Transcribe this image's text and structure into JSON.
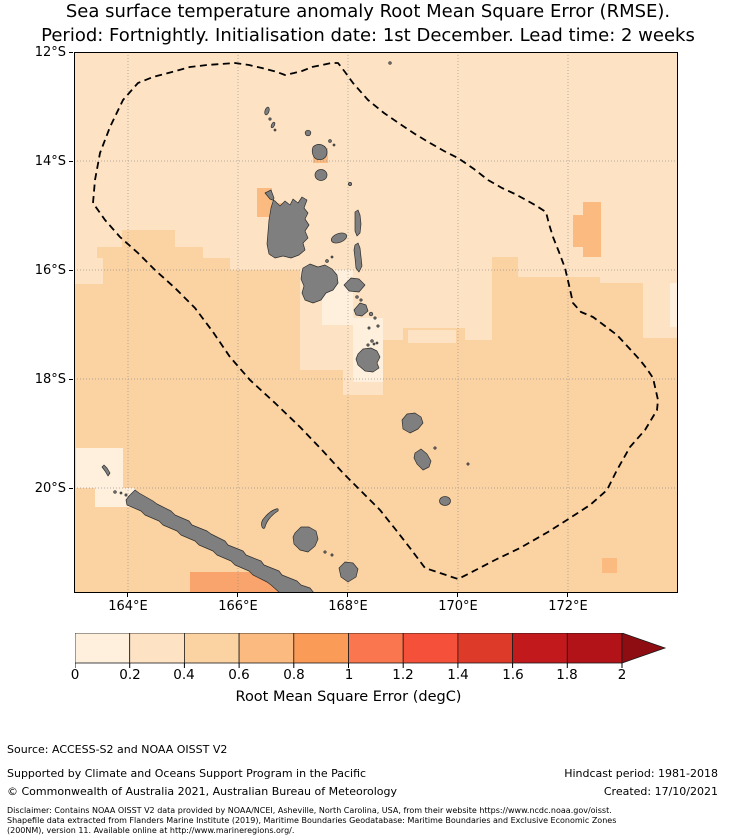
{
  "title": {
    "line1": "Sea surface temperature anomaly Root Mean Square Error (RMSE).",
    "line2": "Period: Fortnightly. Initialisation date: 1st December. Lead time: 2 weeks"
  },
  "map": {
    "lat_labels": [
      "12°S",
      "14°S",
      "16°S",
      "18°S",
      "20°S"
    ],
    "lon_labels": [
      "164°E",
      "166°E",
      "168°E",
      "170°E",
      "172°E"
    ]
  },
  "colorbar": {
    "label": "Root Mean Square Error (degC)",
    "ticks": [
      "0",
      "0.2",
      "0.4",
      "0.6",
      "0.8",
      "1",
      "1.2",
      "1.4",
      "1.6",
      "1.8",
      "2"
    ]
  },
  "footer": {
    "source": "Source: ACCESS-S2 and NOAA OISST V2",
    "supported": "Supported by Climate and Oceans Support Program in the Pacific",
    "copyright": "© Commonwealth of Australia 2021, Australian Bureau of Meteorology",
    "hindcast": "Hindcast period: 1981-2018",
    "created": "Created: 17/10/2021",
    "disclaimer_line1": "Disclaimer: Contains NOAA OISST V2 data provided by NOAA/NCEI, Asheville, North Carolina, USA, from their website https://www.ncdc.noaa.gov/oisst.",
    "disclaimer_line2": "Shapefile data extracted from Flanders Marine Institute (2019), Maritime Boundaries Geodatabase: Maritime Boundaries and Exclusive Economic Zones",
    "disclaimer_line3": "(200NM), version 11. Available online at http://www.marineregions.org/."
  },
  "colors": {
    "scale": [
      "#FEF0DC",
      "#FDE3C3",
      "#FBD2A2",
      "#FBBA80",
      "#FB9B58",
      "#F9764E",
      "#F4503A",
      "#DE3A2A",
      "#C2191D",
      "#B11318"
    ],
    "arrow": "#8E0D12",
    "patch_strong": "#F9A46C",
    "land": "#7F7F7F",
    "land_edge": "#2E2E2E",
    "grid": "#8A8A8A",
    "eez": "#000000",
    "axis": "#000000"
  },
  "chart_data": {
    "type": "heatmap",
    "title": "Sea surface temperature anomaly Root Mean Square Error (RMSE)",
    "subtitle": "Period: Fortnightly. Initialisation date: 1st December. Lead time: 2 weeks",
    "colorbar_label": "Root Mean Square Error (degC)",
    "colorbar_ticks": [
      0,
      0.2,
      0.4,
      0.6,
      0.8,
      1,
      1.2,
      1.4,
      1.6,
      1.8,
      2
    ],
    "colorbar_range": [
      0,
      2
    ],
    "colorbar_extend": "max",
    "map_extent": {
      "lon": [
        "163°E",
        "174°E"
      ],
      "lat": [
        "12°S",
        "22°S"
      ]
    },
    "observed_value_range_degC": [
      0.2,
      0.8
    ],
    "legend_position": "bottom"
  }
}
